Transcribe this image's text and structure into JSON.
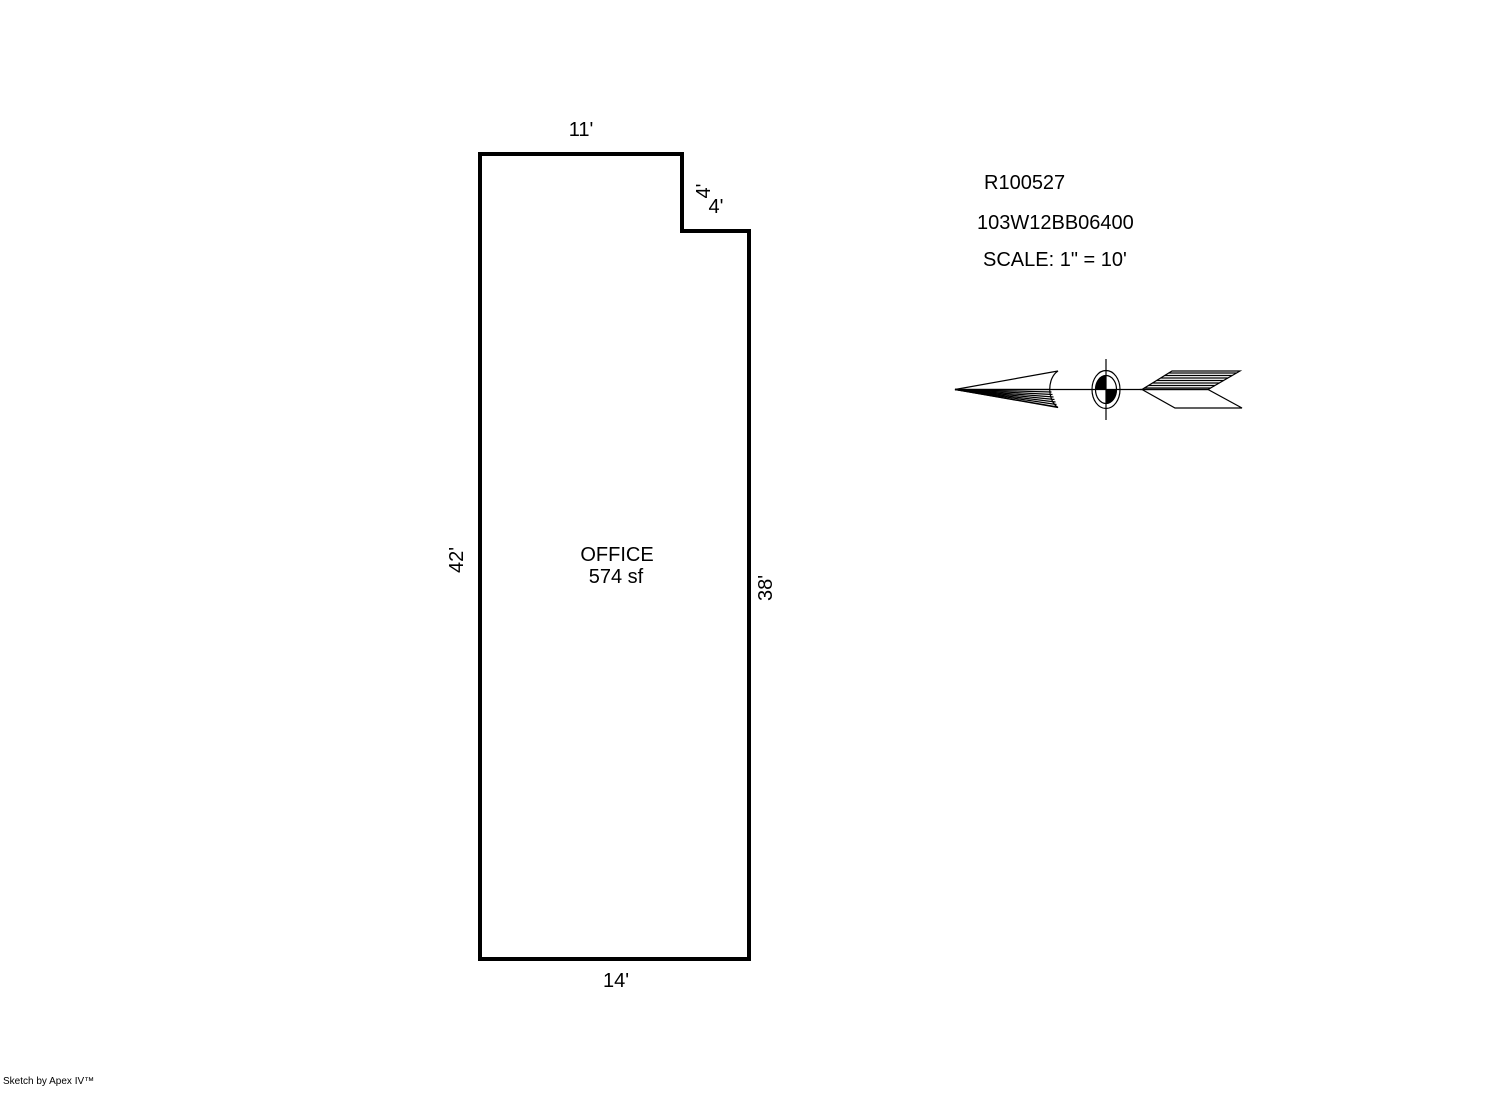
{
  "sketch": {
    "room": {
      "name": "OFFICE",
      "area": "574 sf"
    },
    "dimensions": {
      "top": "11'",
      "notch_vertical": "4'",
      "notch_horizontal": "4'",
      "left": "42'",
      "right": "38'",
      "bottom": "14'"
    }
  },
  "info": {
    "record_id": "R100527",
    "parcel_id": "103W12BB06400",
    "scale": "SCALE: 1\" = 10'"
  },
  "north_arrow": {
    "direction": "left"
  },
  "footer": {
    "credit": "Sketch by Apex IV™"
  },
  "colors": {
    "background": "#ffffff",
    "line": "#000000"
  }
}
